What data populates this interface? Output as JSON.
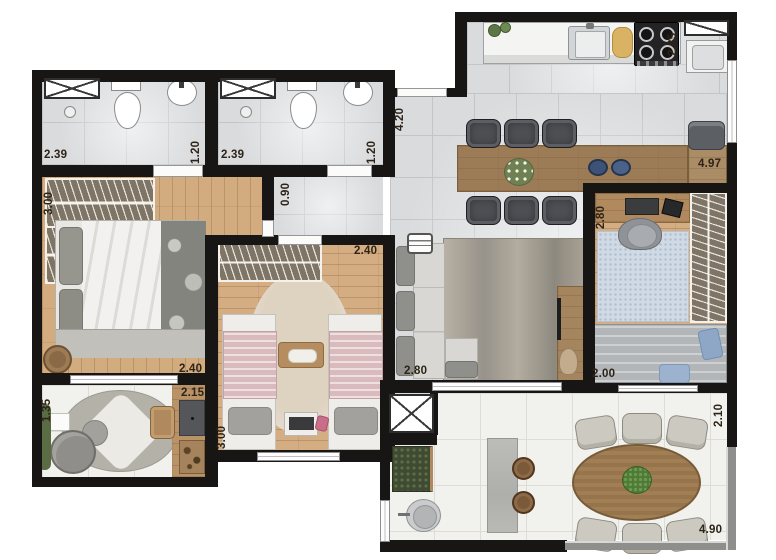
{
  "plan": {
    "kind": "apartment floor plan (top view)",
    "labels": "dimension labels in meters"
  },
  "labels": [
    {
      "id": "bathroom1-width",
      "text": "2.39"
    },
    {
      "id": "bathroom1-depth",
      "text": "1.20"
    },
    {
      "id": "bathroom2-width",
      "text": "2.39"
    },
    {
      "id": "bathroom2-depth",
      "text": "1.20"
    },
    {
      "id": "bedroom1-depth",
      "text": "3.00"
    },
    {
      "id": "hallway-width",
      "text": "0.90"
    },
    {
      "id": "living-depth",
      "text": "4.20"
    },
    {
      "id": "kitchen-depth",
      "text": "2.85"
    },
    {
      "id": "counter-length",
      "text": "4.97"
    },
    {
      "id": "bedroom2-width",
      "text": "2.40"
    },
    {
      "id": "office-width",
      "text": "2.80"
    },
    {
      "id": "bedroom1-width",
      "text": "2.40"
    },
    {
      "id": "den-width",
      "text": "2.15"
    },
    {
      "id": "den-depth",
      "text": "1.35"
    },
    {
      "id": "bedroom2-depth",
      "text": "3.00"
    },
    {
      "id": "living-width",
      "text": "2.80"
    },
    {
      "id": "office-sofa-wall",
      "text": "2.00"
    },
    {
      "id": "terrace-depth",
      "text": "2.10"
    },
    {
      "id": "terrace-width",
      "text": "4.90"
    }
  ],
  "rooms": {
    "bathroom_1": {
      "width": "2.39",
      "depth": "1.20"
    },
    "bathroom_2": {
      "width": "2.39",
      "depth": "1.20"
    },
    "bedroom_1": {
      "depth": "3.00",
      "width": "2.40"
    },
    "bedroom_2": {
      "width": "2.40",
      "depth": "3.00"
    },
    "hallway": {
      "width": "0.90"
    },
    "living_dining": {
      "depth": "4.20",
      "width": "2.80"
    },
    "kitchen": {
      "depth": "2.85",
      "counter_length": "4.97"
    },
    "home_office": {
      "width": "2.80",
      "sofa_wall": "2.00"
    },
    "den_nook": {
      "depth": "1.35",
      "width": "2.15"
    },
    "terrace": {
      "depth": "2.10",
      "width": "4.90"
    }
  },
  "colors": {
    "wall": "#181614",
    "wood_floor": "#d2ac7f",
    "counter_wood": "#9c7c56",
    "tile_grey": "#d9dbdd",
    "tile_white": "#f1f1ee",
    "wardrobe_fill": "#7e7566",
    "bed2_blanket_pink": "#d9babd",
    "office_rug_blue": "#d0dae4",
    "pillow_blue": "#8ea7c6",
    "terrace_chair": "#ccc9c0",
    "dining_chair_dark": "#4e4f53",
    "label_text": "#2e2317"
  },
  "icons": {
    "shaft": "crossed-box",
    "shower_stall": "crossed-box",
    "kitchen_window": "diagonal-box",
    "stove": "four-burner-cooktop",
    "ac_unit": "vent-grille"
  }
}
